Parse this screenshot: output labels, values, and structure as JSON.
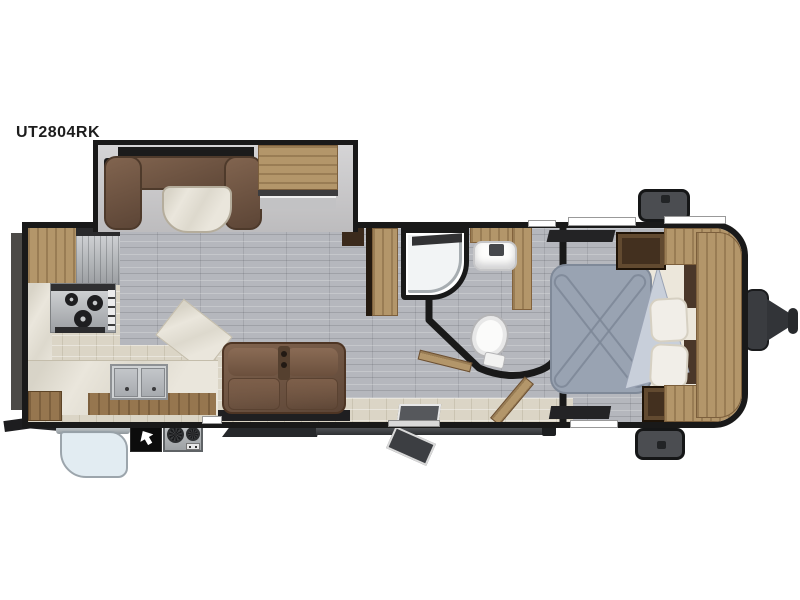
{
  "model_label": "UT2804RK",
  "colors": {
    "bg": "#ffffff",
    "wall": "#191919",
    "floor-plank": "#b5b7bd",
    "floor-tile": "#dbd5c6",
    "marble": "#eae6dc",
    "wood-light": "#b3966a",
    "wood-mid": "#96764f",
    "wood-dark": "#43301f",
    "booth-brown": "#6f5444",
    "comforter": "#99a3b2",
    "comforter-fold": "#c8cfda",
    "bedding-cream": "#ece7db",
    "awning-fabric": "#e1ebf2",
    "exterior-gray": "#4b4d51",
    "hitch-gray": "#3a3c40",
    "window-black": "#1b1b1b"
  },
  "floorplan_parts": [
    "dinette-slide",
    "u-dinette-booth",
    "dinette-table",
    "overhead-cabinet",
    "refrigerator",
    "range-cooktop",
    "double-kitchen-sink",
    "kitchen-counter",
    "pantry-cabinet",
    "theater-loveseat",
    "shower",
    "bathroom-vanity-sink",
    "toilet",
    "queen-bed",
    "nightstands",
    "front-wardrobe",
    "entry-door",
    "fold-out-step",
    "patio-awning",
    "outdoor-kitchen-griddle",
    "front-storage-compartments",
    "a-frame-hitch"
  ]
}
